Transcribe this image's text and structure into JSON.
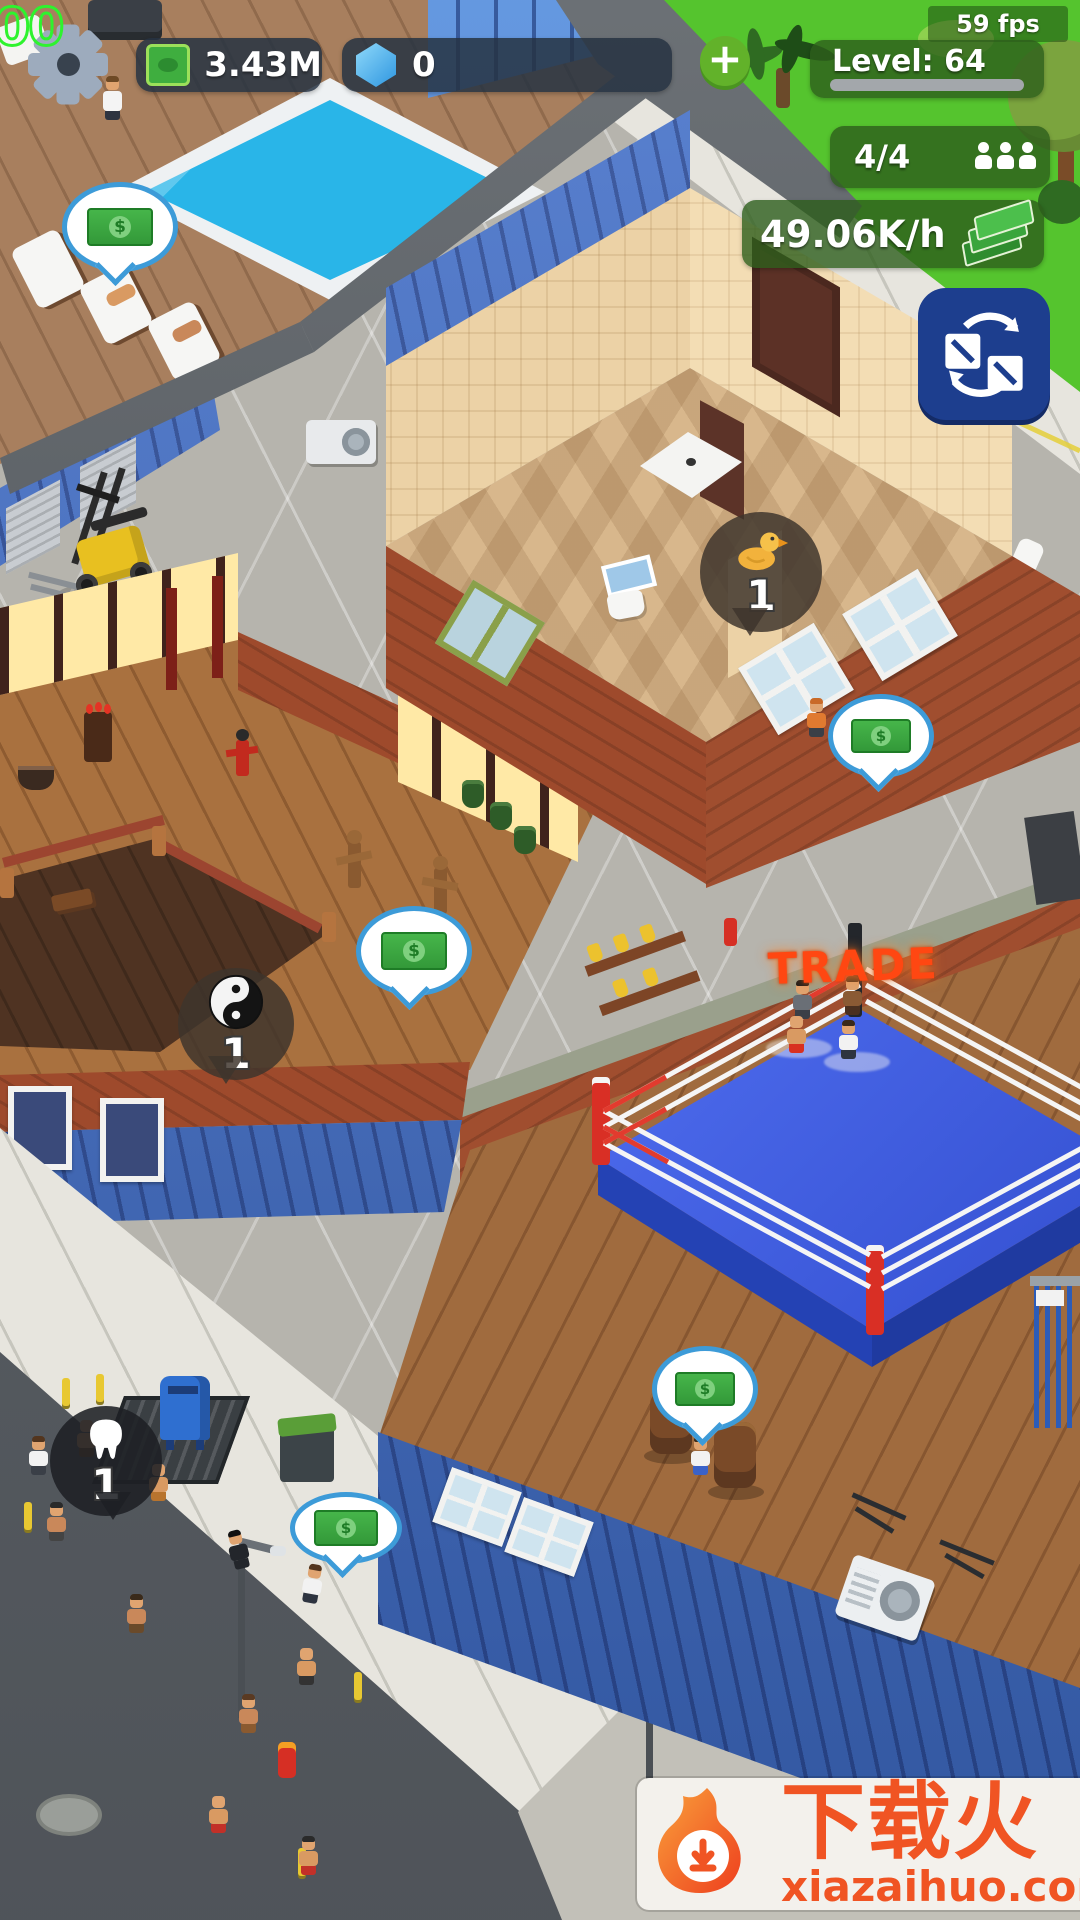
{
  "hud": {
    "debug_counter": "00",
    "money": "3.43M",
    "gems": "0",
    "plus_label": "+",
    "fps": "59 fps",
    "level_label": "Level: 64",
    "workers_count": "4/4",
    "income_rate": "49.06K/h"
  },
  "world": {
    "trade_label": "TRADE",
    "bubbles": {
      "duck_count": "1",
      "yinyang_count": "1",
      "tooth_count": "1",
      "money_symbol": "$"
    }
  },
  "watermark": {
    "title": "下载火",
    "url": "xiazaihuo.com"
  },
  "colors": {
    "grass_green": "#55c42e",
    "hud_badge_green": "#2d5e1c",
    "hud_pill_dark": "#263242",
    "money_green": "#3fae3f",
    "gem_blue": "#4db2f2",
    "trade_orange": "#ff4712",
    "ring_blue": "#3a5cf0",
    "watermark_orange": "#f05423"
  }
}
